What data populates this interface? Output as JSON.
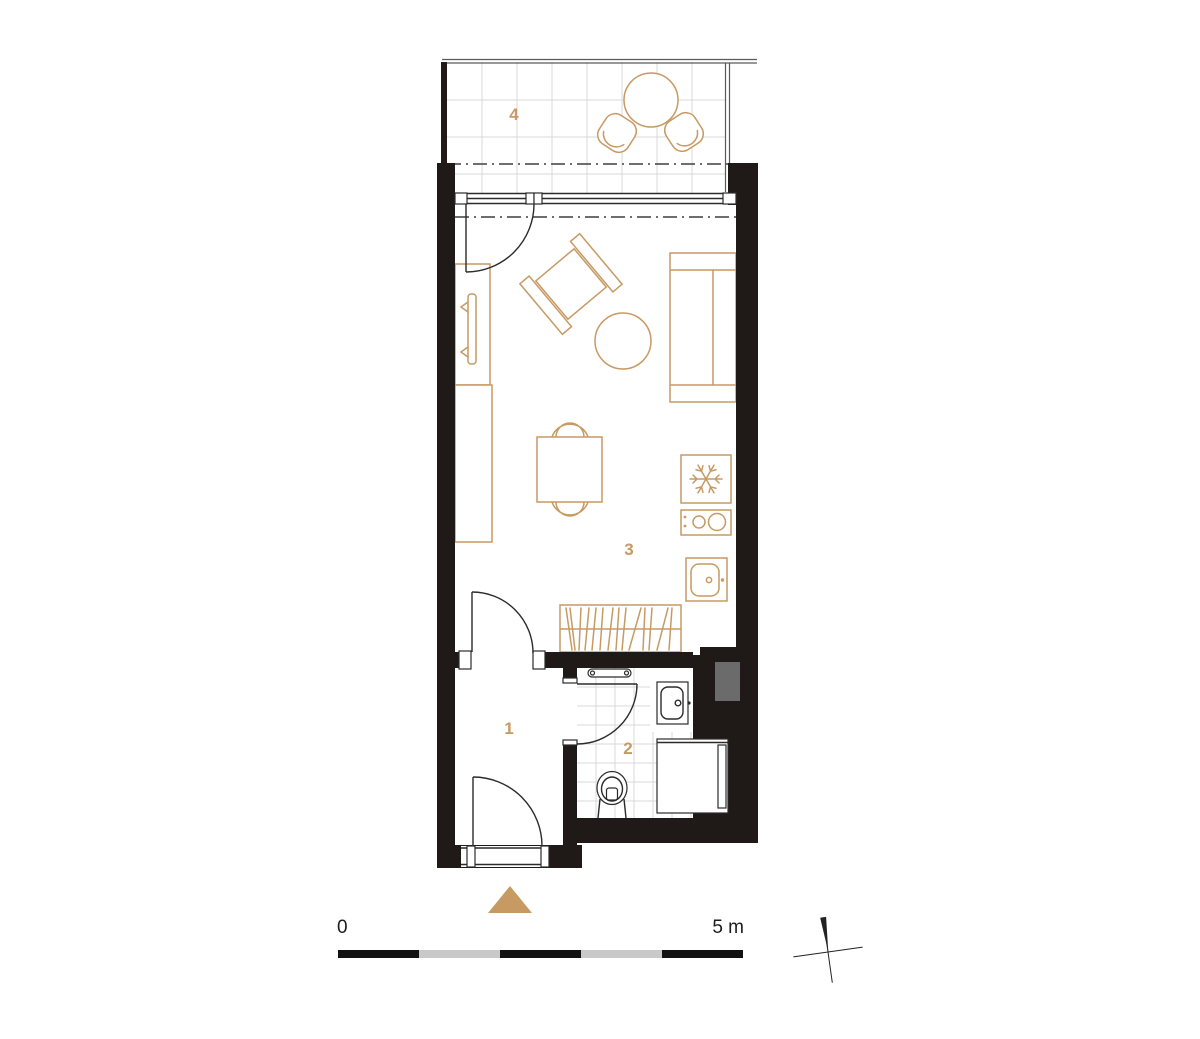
{
  "rooms": [
    {
      "label": "1"
    },
    {
      "label": "2"
    },
    {
      "label": "3"
    },
    {
      "label": "4"
    }
  ],
  "scale_bar": {
    "start": "0",
    "end": "5 m",
    "segments": 5
  },
  "colors": {
    "wall": "#1f1a17",
    "accent": "#c79a63",
    "line": "#2b2b2b",
    "tile": "#d9d9d9",
    "shaft": "#6b6b6b",
    "scale_dark": "#121212",
    "scale_gray": "#c9c9c9"
  }
}
